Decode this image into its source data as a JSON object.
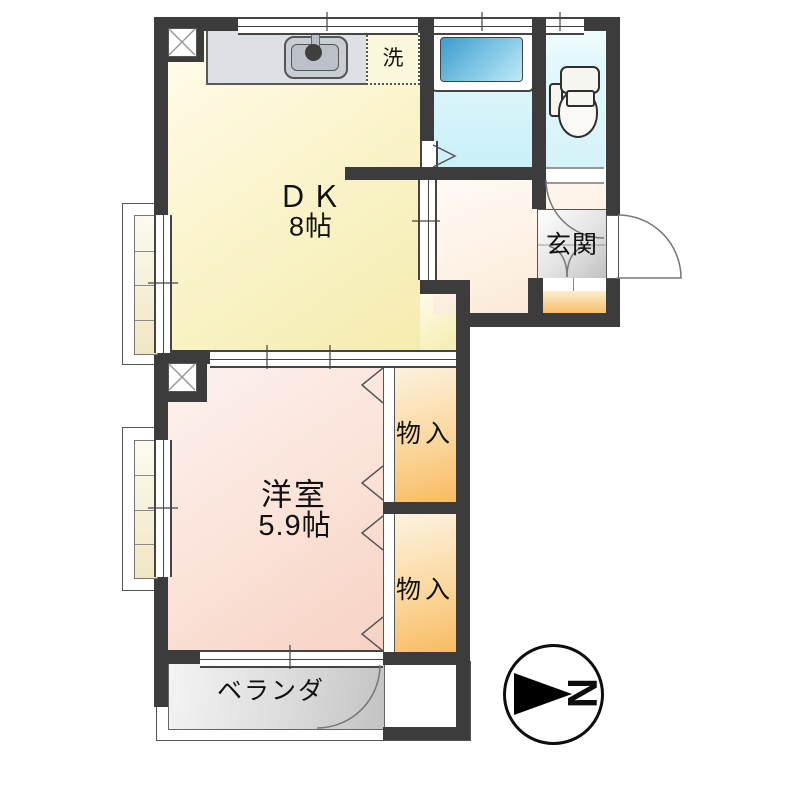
{
  "plan_title": "1DK apartment floor plan",
  "rooms": {
    "dk": {
      "label": "ＤＫ",
      "size": "8帖"
    },
    "western": {
      "label": "洋室",
      "size": "5.9帖"
    },
    "closet_upper": {
      "label": "物入"
    },
    "closet_lower": {
      "label": "物入"
    },
    "genkan": {
      "label": "玄関"
    },
    "laundry": {
      "label": "洗"
    },
    "veranda": {
      "label": "ベランダ"
    }
  },
  "compass": {
    "letter": "N",
    "direction": "right"
  },
  "fixtures": [
    "kitchen-sink",
    "bathtub",
    "toilet",
    "washing-machine-space"
  ],
  "colors": {
    "wall": "#3c3c3c",
    "dk_floor": "#f5ecae",
    "western_floor": "#f6d2c3",
    "hall_floor": "#fae5d2",
    "closet_floor": "#f8bb62",
    "genkan_step": "#f8bd6a",
    "genkan_floor": "#bfbfbf",
    "bath_floor": "#c9f0f8",
    "bathtub": "#3c9bcd",
    "toilet_floor": "#d6f3fa",
    "veranda_floor": "#c3c3c3",
    "counter": "#dde1e6",
    "laundry_bg": "#fbf7dc"
  }
}
